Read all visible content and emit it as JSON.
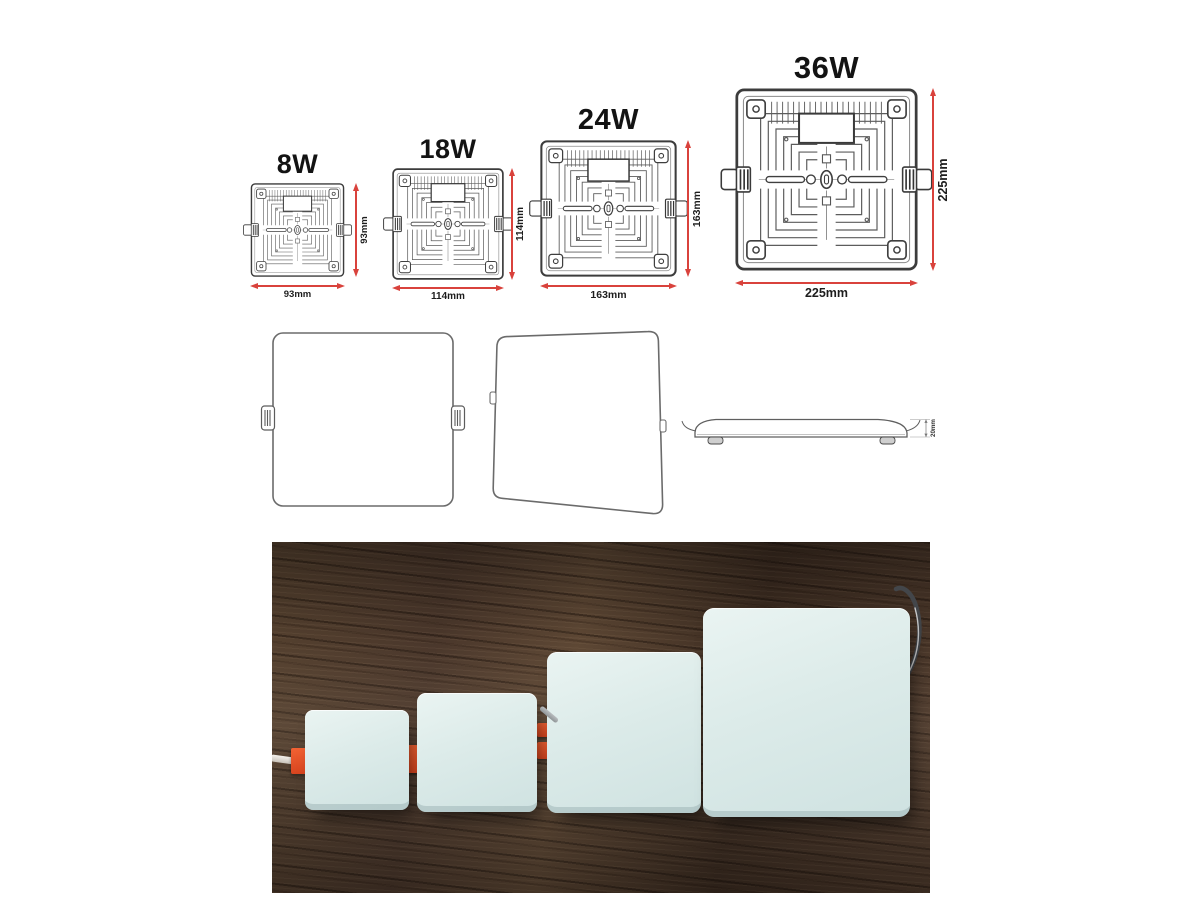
{
  "palette": {
    "background": "#ffffff",
    "dimension_red": "#d9423c",
    "drawing_line_grey": "#5c5c5c",
    "panel_blue": "#dcebe9",
    "wood_brown": "#46352a",
    "clip_orange": "#e8532b"
  },
  "spec_drawings": [
    {
      "wattage_label": "8W",
      "side_dim_label": "93mm",
      "bottom_dim_label": "93mm"
    },
    {
      "wattage_label": "18W",
      "side_dim_label": "114mm",
      "bottom_dim_label": "114mm"
    },
    {
      "wattage_label": "24W",
      "side_dim_label": "163mm",
      "bottom_dim_label": "163mm"
    },
    {
      "wattage_label": "36W",
      "side_dim_label": "225mm",
      "bottom_dim_label": "225mm"
    }
  ],
  "outline_views": {
    "thickness_dim_label": "20mm"
  },
  "photo": {
    "panel_count": 4
  }
}
